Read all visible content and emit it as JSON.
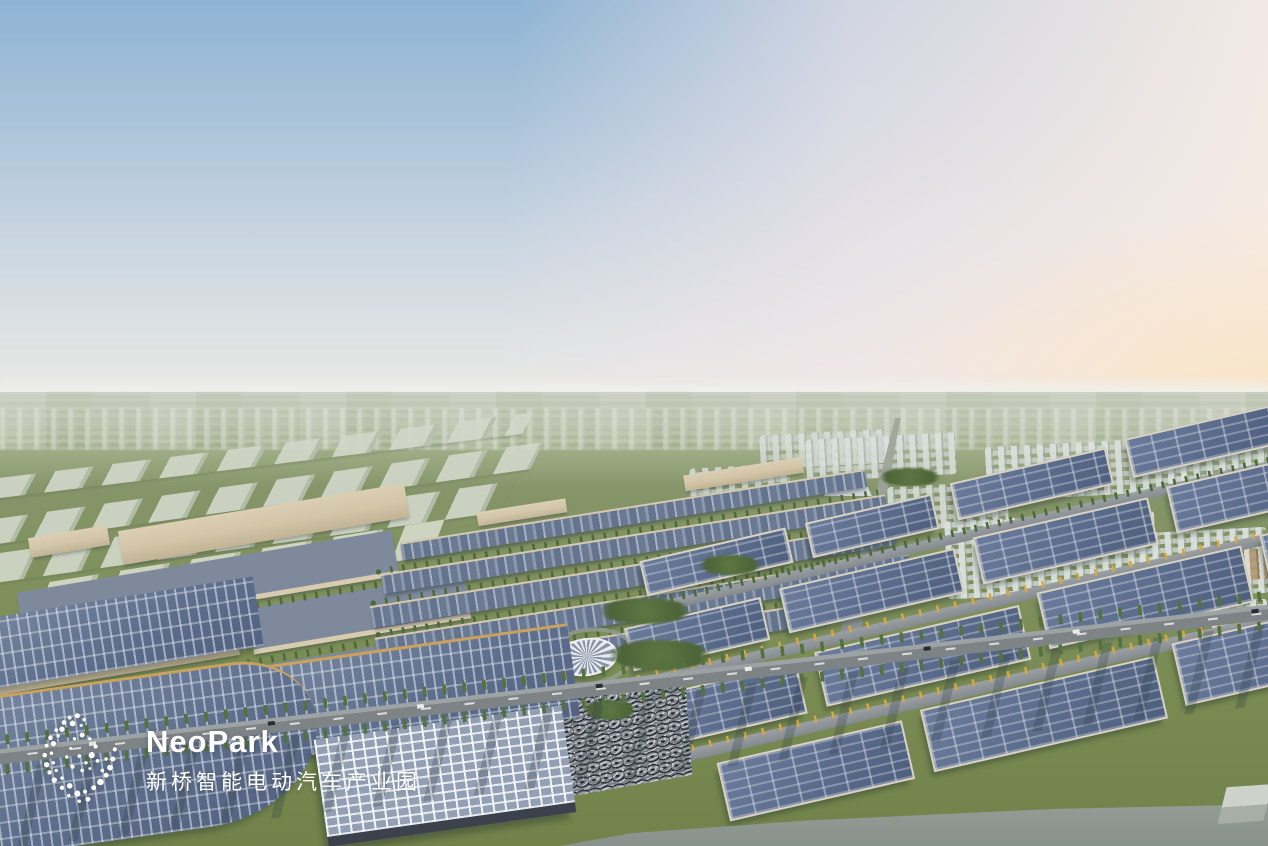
{
  "scene": {
    "description": "Aerial architectural rendering of the NeoPark smart electric-vehicle industrial park: rows of factory halls and warehouses with blue solar-panel roofs, tree-lined boulevards, a round exhibition building, distant residential towers and green fields under a hazy blue-to-pink sunrise sky",
    "branding": {
      "logo_name": "NeoPark",
      "logo_subtitle": "新桥智能电动汽车产业园"
    },
    "palette": {
      "sky-blue": "#8fb4d4",
      "sky-pink": "#f3e9e9",
      "sunset-glow": "#f9e6c8",
      "field-green": "#8c9c6d",
      "lawn-green": "#7a8c54",
      "tree-green": "#4d6a3a",
      "accent-tree-yellow": "#d9a73f",
      "solar-roof": "#637391",
      "roof-beige": "#d2c5a8",
      "road-grey": "#7e8386",
      "white-structure": "#e9ecee",
      "water-grey": "#97a098",
      "logo-white": "#ffffff"
    }
  }
}
